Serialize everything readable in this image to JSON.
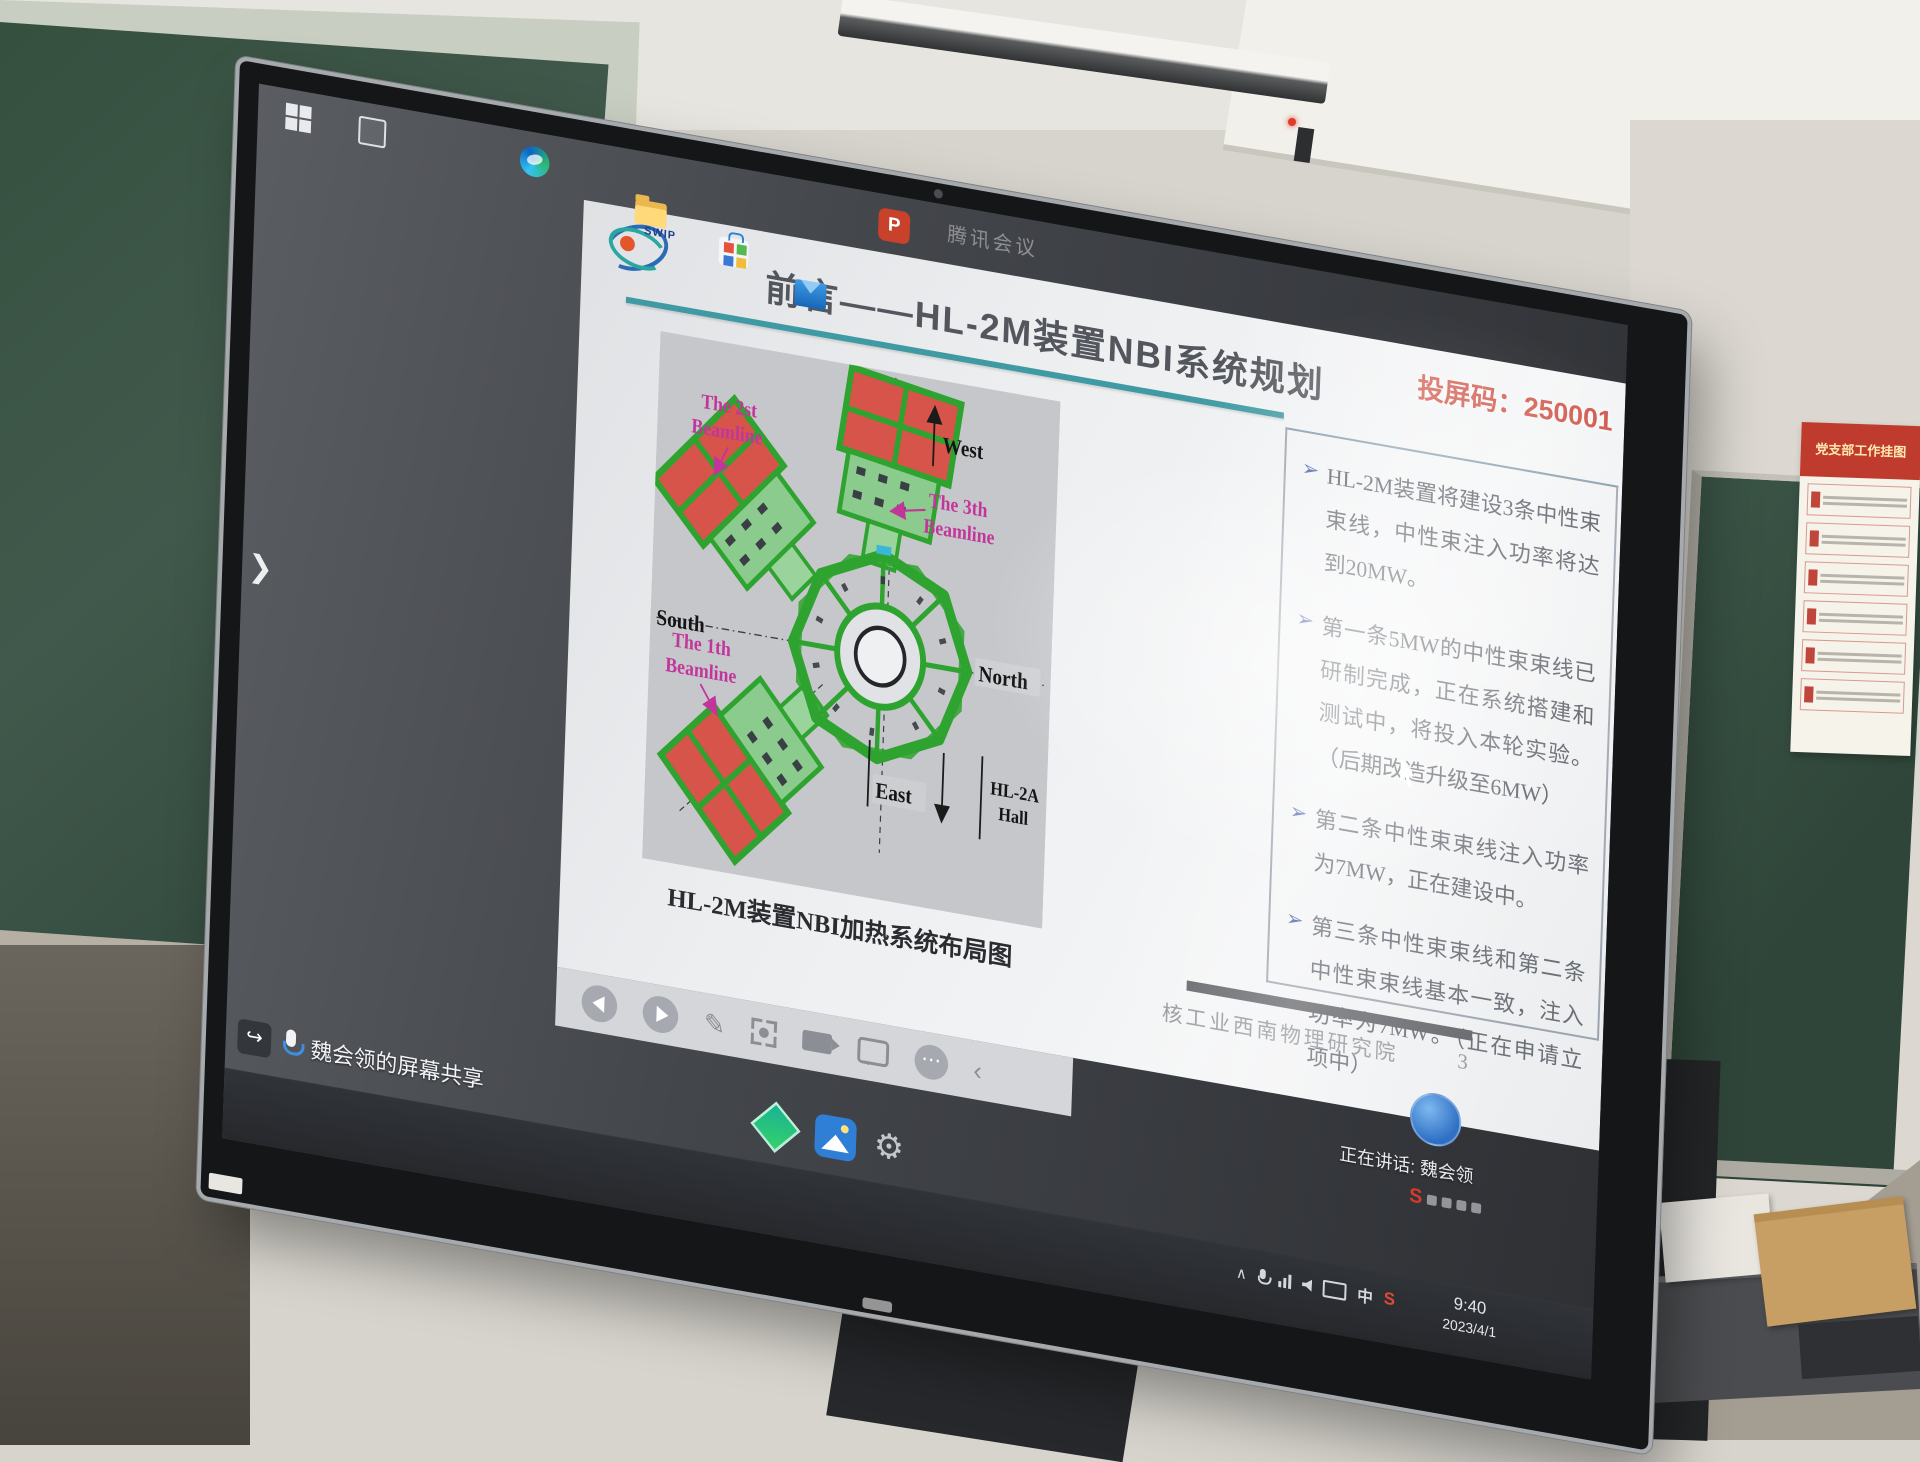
{
  "room": {
    "poster": {
      "title": "党支部工作挂图"
    }
  },
  "display": {
    "meeting_watermark": "腾讯会议",
    "cast_code": "投屏码：250001",
    "sidebar_chevron": "❯",
    "right_chevron": "‹",
    "speaking_label": "正在讲话: 魏会领",
    "brand_mark": "S",
    "slide": {
      "logo_text": "SWIP",
      "title": "前言——HL-2M装置NBI系统规划",
      "caption": "HL-2M装置NBI加热系统布局图",
      "bullet_marker": "➢",
      "bullets": [
        "HL-2M装置将建设3条中性束束线，中性束注入功率将达到20MW。",
        "第一条5MW的中性束束线已研制完成，正在系统搭建和测试中，将投入本轮实验。（后期改造升级至6MW）",
        "第二条中性束束线注入功率为7MW，正在建设中。",
        "第三条中性束束线和第二条中性束束线基本一致，注入功率为7MW。（正在申请立项中）"
      ],
      "footer_org": "核工业西南物理研究院",
      "page_number": "3",
      "diagram": {
        "beamline1": [
          "The 1th",
          "Beamline"
        ],
        "beamline2": [
          "The 2st",
          "Beamline"
        ],
        "beamline3": [
          "The 3th",
          "Beamline"
        ],
        "west": "West",
        "south": "South",
        "north": "North",
        "east": "East",
        "hall": [
          "HL-2A",
          "Hall"
        ]
      }
    },
    "toolbar": {
      "more_glyph": "⋯",
      "pen_glyph": "✎",
      "collapse_glyph": "‹",
      "icons": [
        "back",
        "forward",
        "pen",
        "capture",
        "record",
        "comment",
        "more",
        "collapse"
      ]
    },
    "taskbar": {
      "share_label": "魏会领的屏幕共享",
      "powerpoint_letter": "P",
      "gear_glyph": "⚙",
      "icons": [
        "start",
        "task-view",
        "edge",
        "file-explorer",
        "store",
        "mail",
        "powerpoint"
      ]
    },
    "tray": {
      "expand_glyph": "∧",
      "ime": "中",
      "time": "9:40",
      "date": "2023/4/1"
    },
    "colors": {
      "accent_teal": "#3f9aa3",
      "cast_red": "#cd4638",
      "label_magenta": "#c2369b",
      "bullet_blue": "#3d56a6",
      "device_green": "#2fa32f",
      "panel_red": "#d6544a"
    }
  }
}
